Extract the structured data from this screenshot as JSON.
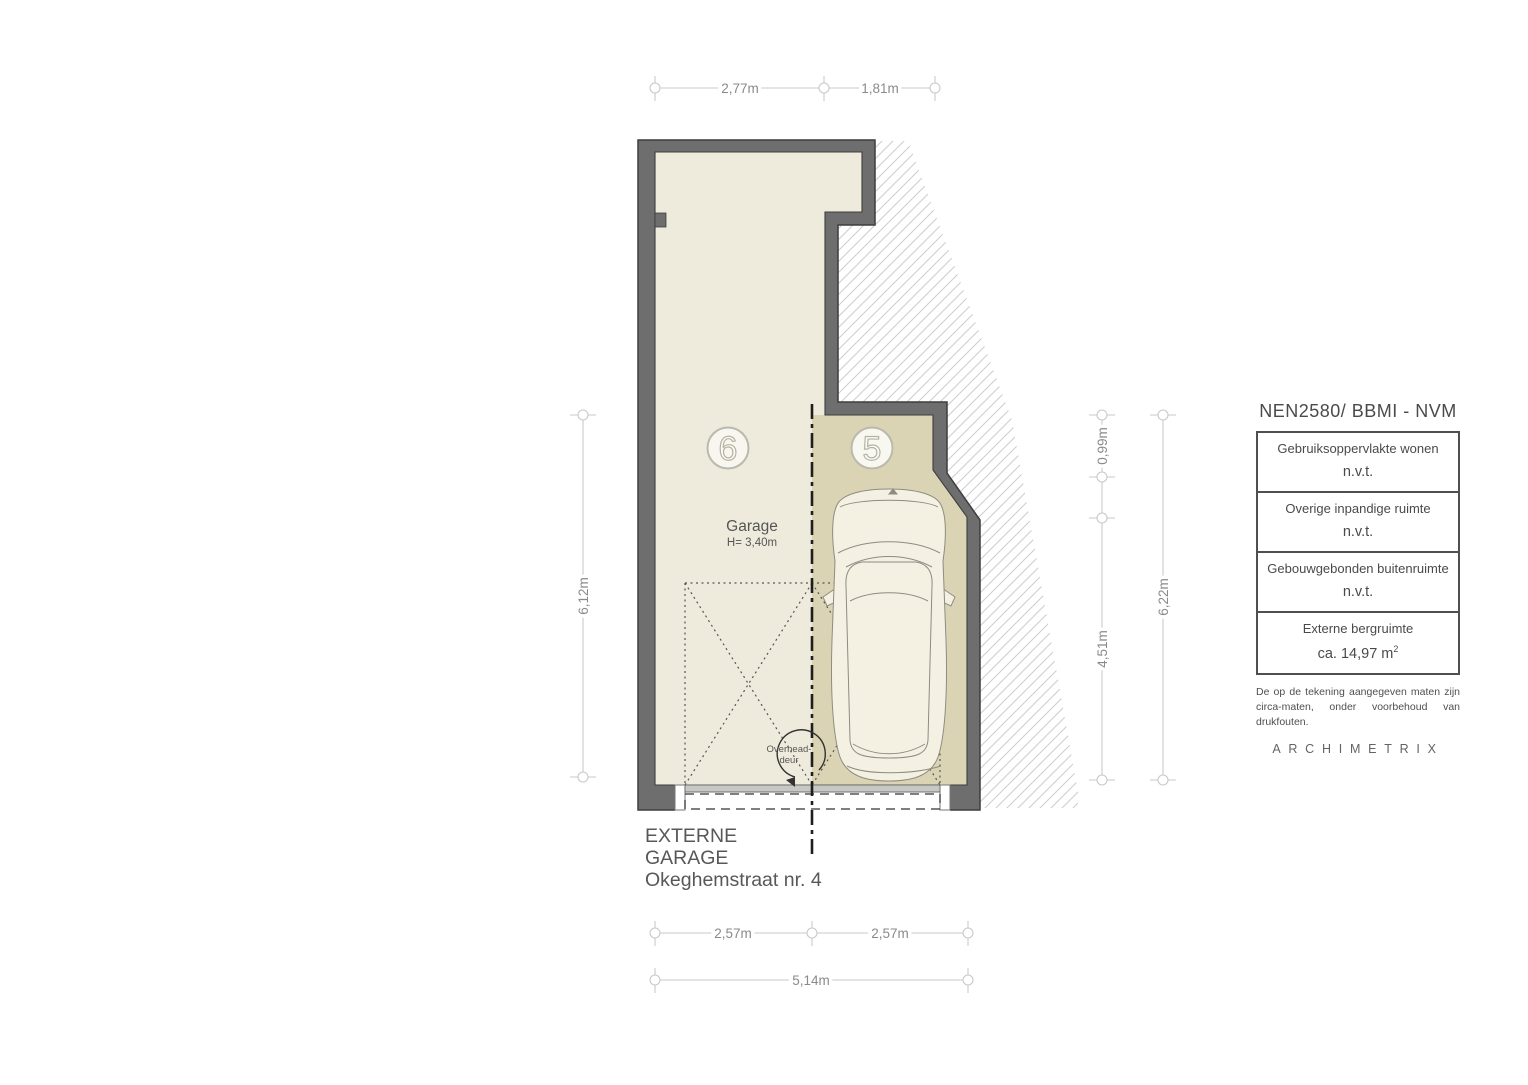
{
  "drawing": {
    "dimensions": {
      "top": [
        "2,77m",
        "1,81m"
      ],
      "left": [
        "6,12m"
      ],
      "right_inner": [
        "0,99m",
        "4,51m"
      ],
      "right_outer": [
        "6,22m"
      ],
      "bottom_row1": [
        "2,57m",
        "2,57m"
      ],
      "bottom_row2": [
        "5,14m"
      ]
    },
    "labels": {
      "room": "Garage",
      "room_height": "H= 3,40m",
      "door_line1": "Overhead-",
      "door_line2": "deur",
      "spot_left": "6",
      "spot_right": "5"
    },
    "title": {
      "line1": "EXTERNE",
      "line2": "GARAGE",
      "line3": "Okeghemstraat nr. 4"
    }
  },
  "legend": {
    "title": "NEN2580/ BBMI - NVM",
    "rows": [
      {
        "label": "Gebruiksoppervlakte wonen",
        "value": "n.v.t.",
        "value_sup": ""
      },
      {
        "label": "Overige inpandige ruimte",
        "value": "n.v.t.",
        "value_sup": ""
      },
      {
        "label": "Gebouwgebonden buitenruimte",
        "value": "n.v.t.",
        "value_sup": ""
      },
      {
        "label": "Externe bergruimte",
        "value": "ca. 14,97 m",
        "value_sup": "2"
      }
    ],
    "disclaimer": [
      "De op de tekening aangegeven maten zijn",
      "circa-maten, onder voorbehoud van drukfouten."
    ],
    "brand": "ARCHIMETRIX"
  },
  "colors": {
    "wall": "#6e6e6e",
    "wall_outline": "#3d3d3d",
    "interior": "#efebdc",
    "parking": "#dbd4b4",
    "hatch_line": "#cccccc",
    "dim": "#8a8a8a",
    "text": "#555555",
    "car_fill": "#f4f1e3"
  }
}
